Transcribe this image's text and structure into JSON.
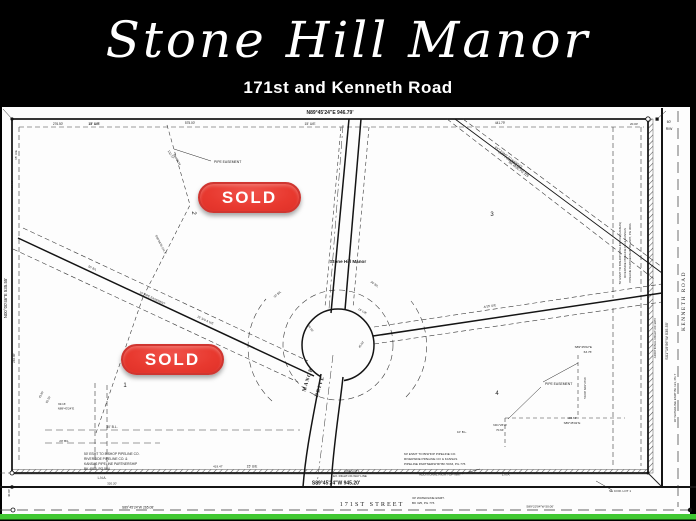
{
  "header": {
    "title": "Stone Hill Manor",
    "subtitle": "171st and Kenneth Road"
  },
  "colors": {
    "badge_red": "#e8392f",
    "badge_border": "#cf3631",
    "accent_green": "#41c832",
    "header_bg": "#000000",
    "paper_white": "#ffffff",
    "map_ink": "#1d1d1d"
  },
  "sold_badges": [
    {
      "label": "SOLD",
      "x": 198,
      "y": 182
    },
    {
      "label": "SOLD",
      "x": 121,
      "y": 344
    }
  ],
  "plat": {
    "street_names": [
      "MANOR DRIVE",
      "171ST STREET",
      "KENNETH ROAD"
    ],
    "subdivision_name": "Stone Hill Manor",
    "lot_numbers": [
      "1",
      "2",
      "3",
      "4"
    ],
    "labels": [
      {
        "t": "N89°45'24\"E  946.79'",
        "x": 330,
        "y": 11,
        "s": 5,
        "w": "bold"
      },
      {
        "t": "276.50'",
        "x": 58,
        "y": 22,
        "s": 3.2
      },
      {
        "t": "15' U/E",
        "x": 94,
        "y": 22,
        "s": 3.4,
        "w": "bold"
      },
      {
        "t": "575.00'",
        "x": 190,
        "y": 21,
        "s": 3.2
      },
      {
        "t": "15' U/E",
        "x": 310,
        "y": 22,
        "s": 3.4
      },
      {
        "t": "441.79'",
        "x": 500,
        "y": 21,
        "s": 3.2
      },
      {
        "t": "20.00'",
        "x": 634,
        "y": 22,
        "s": 3
      },
      {
        "t": "60'",
        "x": 669,
        "y": 20,
        "s": 3.4
      },
      {
        "t": "R/W",
        "x": 669,
        "y": 27,
        "s": 3.4
      },
      {
        "t": "N00°00'46\"E  535.55'",
        "x": 7,
        "y": 195,
        "r": -90,
        "s": 4.4
      },
      {
        "t": "15' U/E",
        "x": 17,
        "y": 52,
        "r": -90,
        "s": 3
      },
      {
        "t": "135.56'",
        "x": 13,
        "y": 82,
        "r": -90,
        "s": 3
      },
      {
        "t": "240.00'",
        "x": 15,
        "y": 255,
        "r": -90,
        "s": 3
      },
      {
        "t": "40.00'",
        "x": 10,
        "y": 390,
        "r": -90,
        "s": 3
      },
      {
        "t": "S01°19'56\"W  535.55'",
        "x": 668,
        "y": 238,
        "r": -90,
        "s": 4
      },
      {
        "t": "KENNETH  ROAD",
        "x": 685,
        "y": 198,
        "r": -90,
        "s": 5.4,
        "f": "serif",
        "ls": 1.5
      },
      {
        "t": "ADDITIONAL RIGHT-OF-WAY",
        "x": 656,
        "y": 235,
        "r": -90,
        "s": 3
      },
      {
        "t": "50' ESMT TO BISHOP PIPELINE CO (KANSAS)",
        "x": 621,
        "y": 150,
        "r": -90,
        "s": 2.9
      },
      {
        "t": "RIVERSIDE PIPELINE CO & KANSAS",
        "x": 626,
        "y": 150,
        "r": -90,
        "s": 2.9
      },
      {
        "t": "PIPELINE PARTNERSHIP BK 2987, PG 300A",
        "x": 631,
        "y": 150,
        "r": -90,
        "s": 2.9
      },
      {
        "t": "30' WATERLINE ESMT  BK 123, PG 7",
        "x": 676,
        "y": 295,
        "r": -90,
        "s": 2.9
      },
      {
        "t": "EXT ESMT TO KANSAS",
        "x": 508,
        "y": 55,
        "r": 37,
        "s": 3.1
      },
      {
        "t": "CITY POWER & LIGHT CO",
        "x": 513,
        "y": 61,
        "r": 37,
        "s": 3.1
      },
      {
        "t": "BK 4436, PG 229",
        "x": 518,
        "y": 67,
        "r": 37,
        "s": 3.1
      },
      {
        "t": "Stone Hill Manor",
        "x": 348,
        "y": 160,
        "s": 4.6,
        "w": "bold"
      },
      {
        "t": "MANOR",
        "x": 309,
        "y": 277,
        "r": -72,
        "s": 5.2,
        "w": "bold",
        "f": "serif",
        "ls": 1
      },
      {
        "t": "DRIVE",
        "x": 321,
        "y": 284,
        "r": -72,
        "s": 5.2,
        "w": "bold",
        "f": "serif",
        "ls": 1
      },
      {
        "t": "1",
        "x": 125,
        "y": 284,
        "s": 6
      },
      {
        "t": "2",
        "x": 192,
        "y": 110,
        "r": 90,
        "s": 6
      },
      {
        "t": "3",
        "x": 492,
        "y": 113,
        "s": 6
      },
      {
        "t": "4",
        "x": 497,
        "y": 292,
        "s": 6
      },
      {
        "t": "PIPE EASEMENT",
        "x": 214,
        "y": 60,
        "s": 3.4,
        "a": "start"
      },
      {
        "t": "132.77'",
        "x": 170,
        "y": 52,
        "r": 60,
        "s": 2.9
      },
      {
        "t": "S40°25'W",
        "x": 176,
        "y": 57,
        "r": 60,
        "s": 2.9
      },
      {
        "t": "S30°06'W  141.5'",
        "x": 160,
        "y": 142,
        "r": 62,
        "s": 2.9
      },
      {
        "t": "50' B/L",
        "x": 92,
        "y": 166,
        "r": 25,
        "s": 2.9
      },
      {
        "t": "15' PIPE EASEMENT",
        "x": 152,
        "y": 196,
        "r": 25,
        "s": 2.9
      },
      {
        "t": "15' S/S & U/E",
        "x": 205,
        "y": 218,
        "r": 25,
        "s": 2.9
      },
      {
        "t": "30' B/L",
        "x": 278,
        "y": 192,
        "r": -40,
        "s": 2.9
      },
      {
        "t": "30' B/L",
        "x": 374,
        "y": 182,
        "r": 35,
        "s": 2.9
      },
      {
        "t": "15' U/E",
        "x": 362,
        "y": 209,
        "r": 30,
        "s": 2.9
      },
      {
        "t": "44.50'",
        "x": 310,
        "y": 226,
        "r": 55,
        "s": 2.8
      },
      {
        "t": "45.00'",
        "x": 362,
        "y": 242,
        "r": -55,
        "s": 2.8
      },
      {
        "t": "A/15' U/E",
        "x": 490,
        "y": 204,
        "r": -9,
        "s": 3
      },
      {
        "t": "S89°45'02\"E",
        "x": 592,
        "y": 245,
        "s": 3.1,
        "a": "end"
      },
      {
        "t": "63.76'",
        "x": 592,
        "y": 250,
        "s": 3.1,
        "a": "end"
      },
      {
        "t": "PIPE EASEMENT",
        "x": 545,
        "y": 282,
        "s": 3.4,
        "a": "start"
      },
      {
        "t": "50.00'  N01°26'W",
        "x": 586,
        "y": 285,
        "r": -90,
        "s": 2.9
      },
      {
        "t": "106.63'",
        "x": 572,
        "y": 316,
        "s": 3
      },
      {
        "t": "S89°45'02\"E",
        "x": 572,
        "y": 321,
        "s": 3
      },
      {
        "t": "N01°26'W",
        "x": 500,
        "y": 323,
        "s": 3
      },
      {
        "t": "70.64'",
        "x": 500,
        "y": 328,
        "s": 3
      },
      {
        "t": "10' B.L.",
        "x": 462,
        "y": 330,
        "s": 3
      },
      {
        "t": "99.16'",
        "x": 62,
        "y": 302,
        "s": 2.9
      },
      {
        "t": "N89°43'24\"E",
        "x": 66,
        "y": 306.5,
        "s": 2.9
      },
      {
        "t": "43.80'",
        "x": 42,
        "y": 292,
        "r": -62,
        "s": 2.8
      },
      {
        "t": "82.50'",
        "x": 49,
        "y": 297,
        "r": -62,
        "s": 2.8
      },
      {
        "t": "30' B.L.",
        "x": 112,
        "y": 325,
        "s": 3.4
      },
      {
        "t": "20' B/L",
        "x": 64,
        "y": 339,
        "s": 3.1
      },
      {
        "t": "50' ESMT TO BISHOP PIPELINE CO.",
        "x": 84,
        "y": 352,
        "s": 3.3,
        "a": "start"
      },
      {
        "t": "RIVERSIDE PIPELINE CO. &",
        "x": 84,
        "y": 357,
        "s": 3.3,
        "a": "start"
      },
      {
        "t": "KANSAS PIPELINE PARTNERSHIP",
        "x": 84,
        "y": 362,
        "s": 3.3,
        "a": "start"
      },
      {
        "t": "BK 4585, PG 584",
        "x": 84,
        "y": 367,
        "s": 3.3,
        "a": "start"
      },
      {
        "t": "419.47'",
        "x": 218,
        "y": 364.5,
        "s": 3
      },
      {
        "t": "15' U/E",
        "x": 252,
        "y": 364.5,
        "s": 3.3
      },
      {
        "t": "L.N.A.",
        "x": 102,
        "y": 376,
        "s": 3.2
      },
      {
        "t": "320.20'",
        "x": 112,
        "y": 381.5,
        "s": 3
      },
      {
        "t": "S89°45'24\"W  265.08'",
        "x": 138,
        "y": 405.5,
        "s": 3.4
      },
      {
        "t": "S89°45'24\"W  945.20'",
        "x": 336,
        "y": 381.5,
        "s": 5,
        "w": "bold"
      },
      {
        "t": "171ST  STREET",
        "x": 372,
        "y": 403,
        "s": 6.2,
        "f": "serif",
        "ls": 2
      },
      {
        "t": "LINE LOT 1",
        "x": 352,
        "y": 369,
        "s": 2.9
      },
      {
        "t": "EX. RIGHT-OF-WAY LINE",
        "x": 350,
        "y": 374,
        "s": 2.9
      },
      {
        "t": "ADDITIONAL  RIGHT-OF-WAY",
        "x": 440,
        "y": 372.5,
        "s": 3.1
      },
      {
        "t": "L.N.A.",
        "x": 506,
        "y": 372.5,
        "s": 3.1
      },
      {
        "t": "60' ESMT TO BISHOP PIPELINE CO.",
        "x": 404,
        "y": 352,
        "s": 3.1,
        "a": "start"
      },
      {
        "t": "RIVERSIDE PIPELINE CO & KANSAS",
        "x": 404,
        "y": 357,
        "s": 3.1,
        "a": "start"
      },
      {
        "t": "PIPELINE PARTNERSHIP BK 5033, PG 776",
        "x": 404,
        "y": 362,
        "s": 3.1,
        "a": "start"
      },
      {
        "t": "30' WATERLINE ESMT.",
        "x": 412,
        "y": 396,
        "s": 3.1,
        "a": "start"
      },
      {
        "t": "BK 325, PG 776",
        "x": 412,
        "y": 401,
        "s": 3.1,
        "a": "start"
      },
      {
        "t": "S89°23'04\"W  50.00'",
        "x": 540,
        "y": 404.5,
        "s": 3.1
      },
      {
        "t": "SE COR. LOT 1",
        "x": 620,
        "y": 389,
        "s": 3.1
      }
    ]
  }
}
